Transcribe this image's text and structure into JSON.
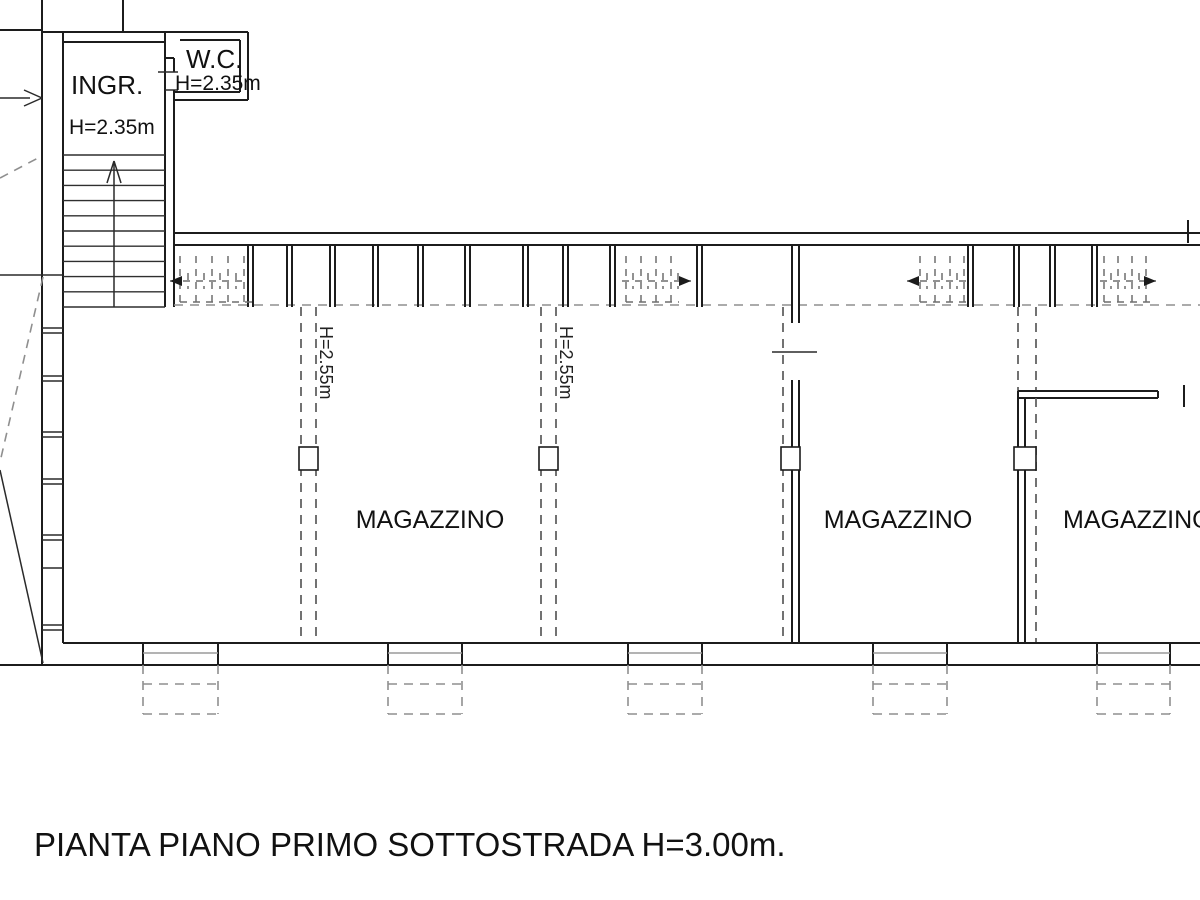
{
  "caption": {
    "text": "PIANTA PIANO PRIMO SOTTOSTRADA H=3.00m."
  },
  "rooms": {
    "ingresso": {
      "label": "INGR.",
      "height": "H=2.35m"
    },
    "wc": {
      "label": "W.C.",
      "height": "H=2.35m"
    },
    "magazzini": [
      {
        "label": "MAGAZZINO"
      },
      {
        "label": "MAGAZZINO"
      },
      {
        "label": "MAGAZZINO"
      }
    ]
  },
  "beams": [
    {
      "label": "H=2.55m"
    },
    {
      "label": "H=2.55m"
    }
  ],
  "colors": {
    "line": "#1c1c1c",
    "dashed": "#8f8f8f",
    "background": "#ffffff"
  }
}
